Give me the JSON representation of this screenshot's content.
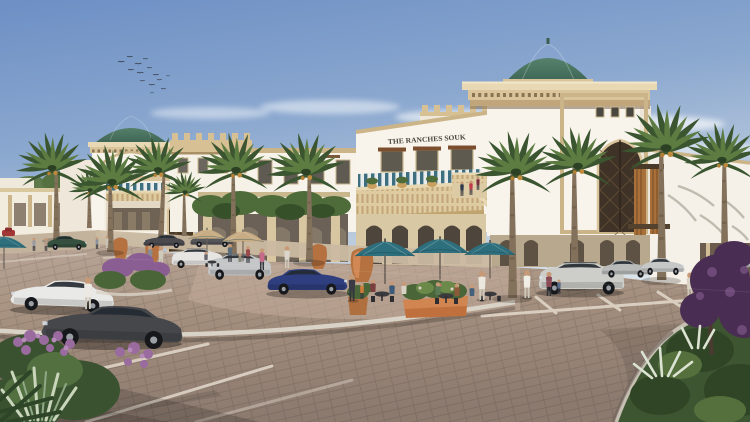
{
  "scene": {
    "type": "architectural-rendering",
    "subject": "Arabian souk style retail center with parking plaza",
    "signage": {
      "building_sign": "THE RANCHES SOUK"
    },
    "palette": {
      "sky_top": "#6D8FC4",
      "sky_horizon": "#ECEEE9",
      "wall_white": "#F8F4EC",
      "sand_trim": "#CBB488",
      "dome_green": "#47705F",
      "umbrella_teal": "#2E6F7E",
      "umbrella_tan": "#C8AD84",
      "pavement": "#A18C80",
      "palm_green": "#3A5530",
      "terracotta": "#B5713F",
      "sign_text": "#4A443C",
      "bougainvillea_purple": "#4A2D52"
    },
    "elements": {
      "birds": "flock of birds in sky",
      "domes": "green tiled domes",
      "cafe": "outdoor cafe terrace with umbrellas",
      "parking": "paved lot with marked stalls and parked cars",
      "landscaping": "date palms, shrubs, purple bougainvillea, terracotta urns"
    }
  }
}
